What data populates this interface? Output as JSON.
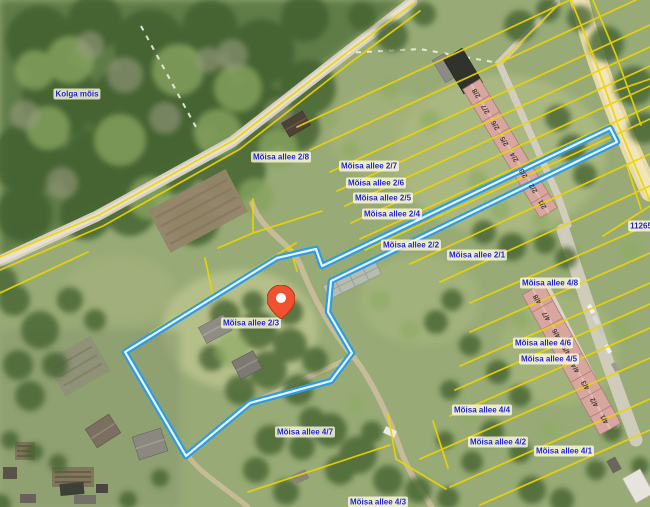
{
  "map": {
    "place_labels": [
      {
        "id": "kolga-mois",
        "text": "Kolga mõis",
        "x": 77,
        "y": 94
      }
    ],
    "parcel_labels": [
      {
        "id": "moisa-allee-2-8",
        "text": "Mõisa allee 2/8",
        "x": 281,
        "y": 157
      },
      {
        "id": "moisa-allee-2-7",
        "text": "Mõisa allee 2/7",
        "x": 369,
        "y": 166
      },
      {
        "id": "moisa-allee-2-6",
        "text": "Mõisa allee 2/6",
        "x": 376,
        "y": 183
      },
      {
        "id": "moisa-allee-2-5",
        "text": "Mõisa allee 2/5",
        "x": 383,
        "y": 198
      },
      {
        "id": "moisa-allee-2-4",
        "text": "Mõisa allee 2/4",
        "x": 392,
        "y": 214
      },
      {
        "id": "moisa-allee-2-2",
        "text": "Mõisa allee 2/2",
        "x": 411,
        "y": 245
      },
      {
        "id": "moisa-allee-2-1",
        "text": "Mõisa allee 2/1",
        "x": 477,
        "y": 255
      },
      {
        "id": "moisa-allee-2-3",
        "text": "Mõisa allee 2/3",
        "x": 251,
        "y": 323
      },
      {
        "id": "moisa-allee-4-8",
        "text": "Mõisa allee 4/8",
        "x": 550,
        "y": 283
      },
      {
        "id": "moisa-allee-4-6",
        "text": "Mõisa allee 4/6",
        "x": 543,
        "y": 343
      },
      {
        "id": "moisa-allee-4-5",
        "text": "Mõisa allee 4/5",
        "x": 549,
        "y": 359
      },
      {
        "id": "moisa-allee-4-4",
        "text": "Mõisa allee 4/4",
        "x": 482,
        "y": 410
      },
      {
        "id": "moisa-allee-4-2",
        "text": "Mõisa allee 4/2",
        "x": 498,
        "y": 442
      },
      {
        "id": "moisa-allee-4-1",
        "text": "Mõisa allee 4/1",
        "x": 564,
        "y": 451
      },
      {
        "id": "moisa-allee-4-7",
        "text": "Mõisa allee 4/7",
        "x": 305,
        "y": 432
      },
      {
        "id": "moisa-allee-4-3",
        "text": "Mõisa allee 4/3",
        "x": 378,
        "y": 502
      },
      {
        "id": "cadastral-11265",
        "text": "11265",
        "x": 638,
        "y": 226
      }
    ],
    "marker": {
      "name": "location-pin",
      "tip_x": 281,
      "tip_y": 319,
      "color": "#F1512E"
    },
    "buildings": {
      "north_rowhouse_units": [
        "2/8",
        "2/7",
        "2/6",
        "2/5",
        "2/4",
        "2/3",
        "2/2",
        "2/1"
      ],
      "east_rowhouse_units": [
        "4/8",
        "4/7",
        "4/6",
        "4/5",
        "4/4",
        "4/3",
        "4/2",
        "4/1"
      ]
    },
    "colors": {
      "cadastral_line": "#EDD400",
      "selected_parcel_outline": "#2D9CE3",
      "label_text": "#1E1ECB",
      "label_background": "#FFFDDA",
      "pin": "#F1512E"
    }
  }
}
